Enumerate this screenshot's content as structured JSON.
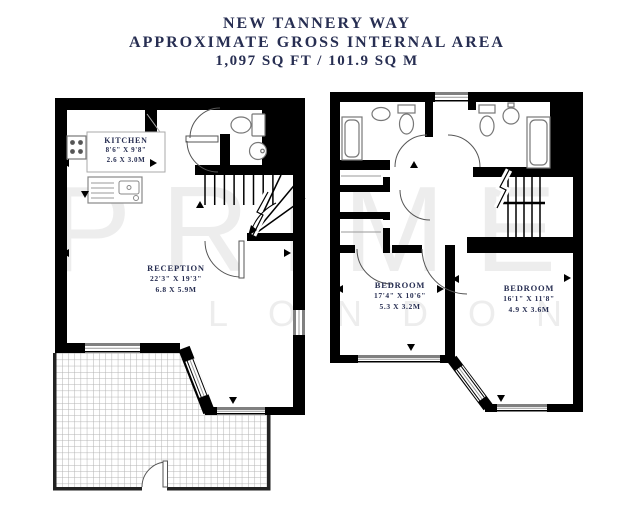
{
  "title": {
    "line1": "NEW TANNERY WAY",
    "line2": "APPROXIMATE GROSS INTERNAL AREA",
    "line3": "1,097 SQ FT / 101.9 SQ M"
  },
  "watermark": {
    "word1": "PRIME",
    "word2": "LONDON"
  },
  "colors": {
    "wall": "#000000",
    "label_text": "#272e52",
    "fixture_outline": "#777777",
    "door_arc": "#555555",
    "hatch_line": "#b3b3b3",
    "watermark": "#ededed"
  },
  "rooms": [
    {
      "id": "kitchen",
      "name": "KITCHEN",
      "imperial": "8'6\" X 9'8\"",
      "metric": "2.6 X 3.0M"
    },
    {
      "id": "reception",
      "name": "RECEPTION",
      "imperial": "22'3\" X 19'3\"",
      "metric": "6.8 X 5.9M"
    },
    {
      "id": "bedroom-1",
      "name": "BEDROOM",
      "imperial": "17'4\" X 10'6\"",
      "metric": "5.3 X 3.2M"
    },
    {
      "id": "bedroom-2",
      "name": "BEDROOM",
      "imperial": "16'1\" X 11'8\"",
      "metric": "4.9 X 3.6M"
    }
  ]
}
